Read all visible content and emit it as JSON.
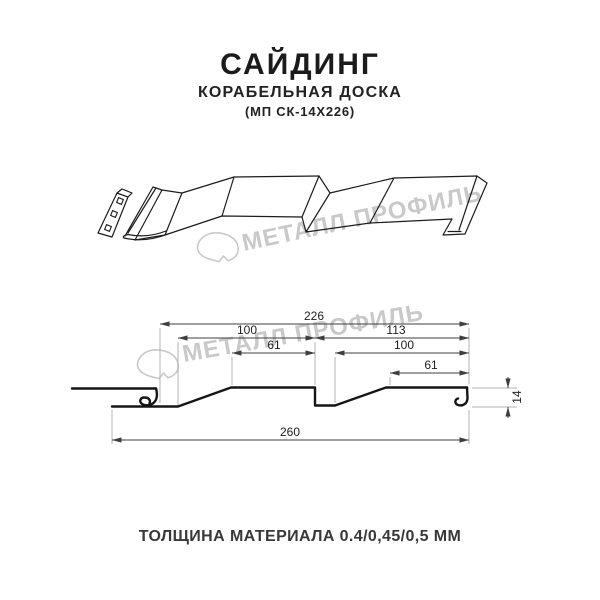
{
  "header": {
    "title": "САЙДИНГ",
    "subtitle": "КОРАБЕЛЬНАЯ ДОСКА",
    "code": "(МП СК-14Х226)"
  },
  "watermark": {
    "brand": "МЕТАЛЛ ПРОФИЛЬ",
    "color": "#c9c9c9"
  },
  "dimensions": {
    "overall_profile_width": "226",
    "left_module_width": "100",
    "right_module_width": "113",
    "left_flat_width": "61",
    "right_visible_width": "100",
    "right_flat_width": "61",
    "total_sheet_width": "260",
    "profile_height": "14"
  },
  "footer": {
    "thickness": "ТОЛЩИНА МАТЕРИАЛА 0.4/0,45/0,5 ММ"
  }
}
